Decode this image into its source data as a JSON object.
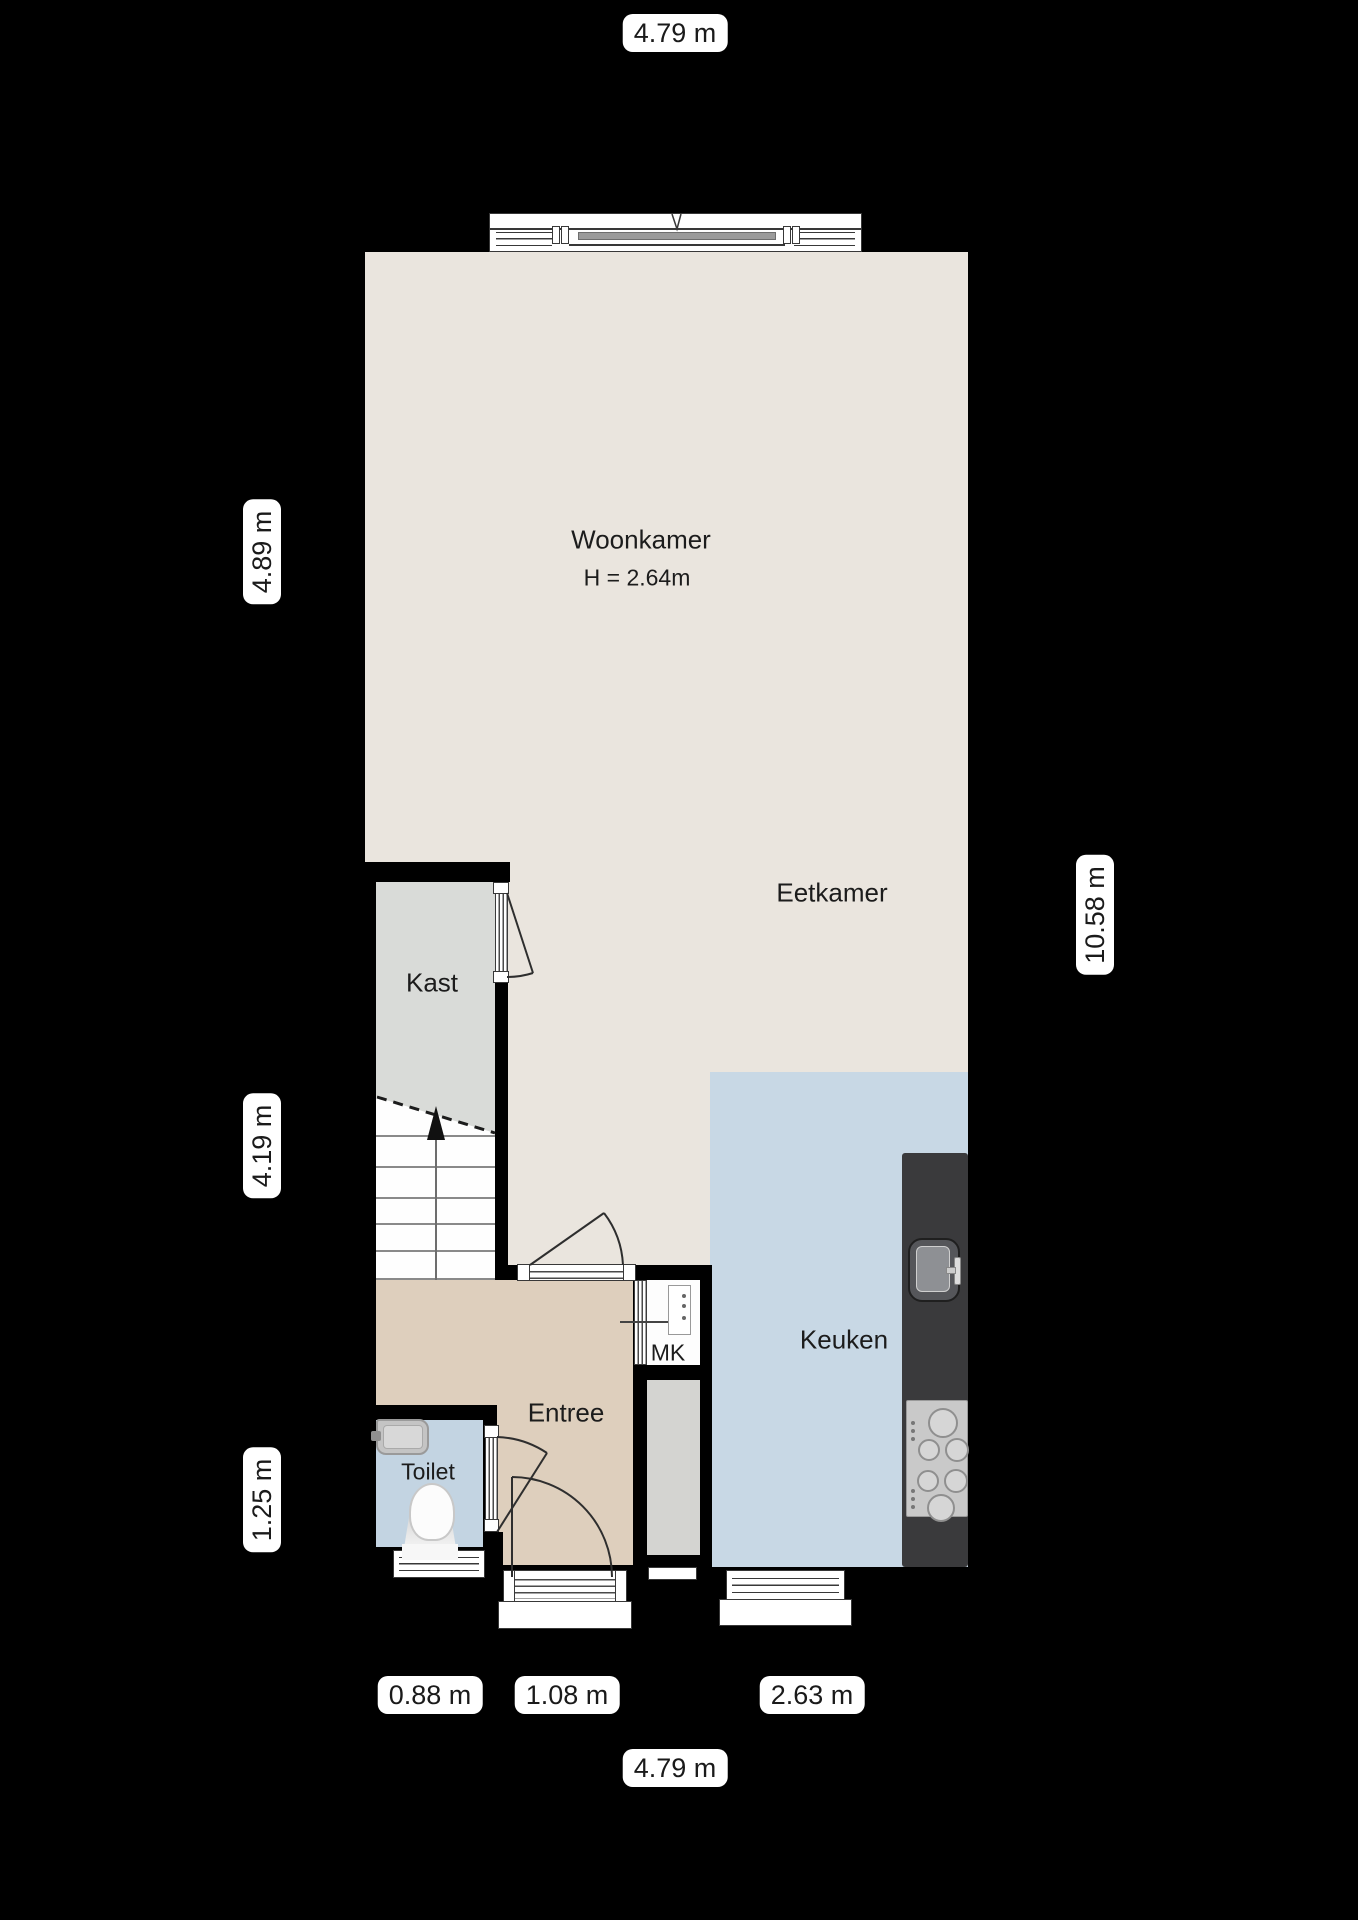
{
  "plan_title": "Begane grond plattegrond",
  "dimensions": {
    "top": "4.79 m",
    "bottom_total": "4.79 m",
    "left_top": "4.89 m",
    "left_mid": "4.19 m",
    "left_bottom": "1.25 m",
    "right": "10.58 m",
    "bottom_segments": [
      "0.88 m",
      "1.08 m",
      "2.63 m"
    ]
  },
  "rooms": {
    "woonkamer": {
      "name": "Woonkamer",
      "height_note": "H = 2.64m"
    },
    "eetkamer": {
      "name": "Eetkamer"
    },
    "kast": {
      "name": "Kast"
    },
    "keuken": {
      "name": "Keuken"
    },
    "entree": {
      "name": "Entree"
    },
    "toilet": {
      "name": "Toilet"
    },
    "mk": {
      "name": "MK"
    }
  },
  "fixtures": [
    "staircase",
    "toilet-bowl",
    "washbasin",
    "kitchen-sink",
    "gas-hob",
    "kitchen-counter",
    "meter-panel"
  ],
  "colors": {
    "background": "#000000",
    "floor_main": "#eae5de",
    "floor_kitchen": "#c8d8e5",
    "floor_entree": "#decfbd",
    "floor_toilet": "#c3d4e2",
    "floor_closet": "#d9dbd8",
    "counter": "#3a3a3c",
    "wall": "#000000",
    "label_pill": "#ffffff",
    "label_text": "#1a1a1a"
  }
}
